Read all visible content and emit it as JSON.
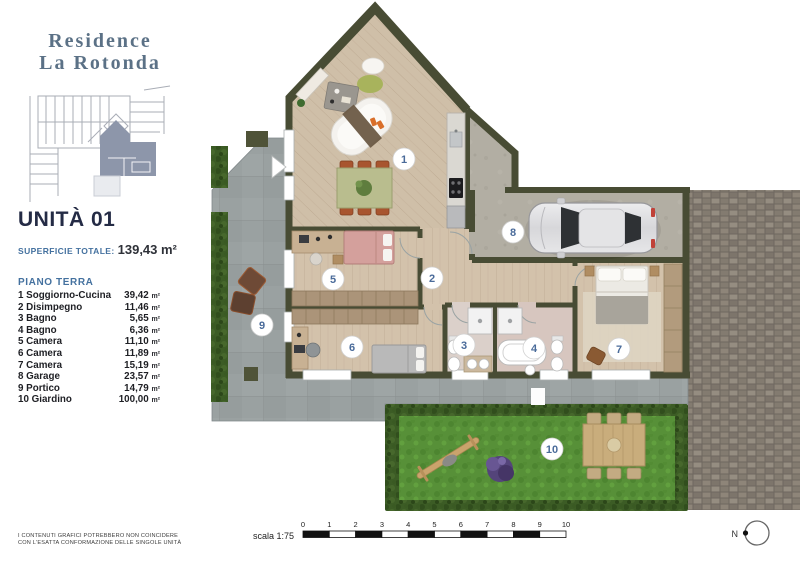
{
  "panel": {
    "brand_line1": "Residence",
    "brand_line2": "La Rotonda",
    "unit_title": "UNITÀ 01",
    "superficie_label": "SUPERFICIE TOTALE:",
    "superficie_value": "139,43 m²",
    "floor_label": "PIANO TERRA",
    "rooms": [
      {
        "name": "1 Soggiorno-Cucina",
        "value": "39,42",
        "unit": "m²"
      },
      {
        "name": "2 Disimpegno",
        "value": "11,46",
        "unit": "m²"
      },
      {
        "name": "3 Bagno",
        "value": "5,65",
        "unit": "m²"
      },
      {
        "name": "4 Bagno",
        "value": "6,36",
        "unit": "m²"
      },
      {
        "name": "5 Camera",
        "value": "11,10",
        "unit": "m²"
      },
      {
        "name": "6 Camera",
        "value": "11,89",
        "unit": "m²"
      },
      {
        "name": "7 Camera",
        "value": "15,19",
        "unit": "m²"
      },
      {
        "name": "8 Garage",
        "value": "23,57",
        "unit": "m²"
      },
      {
        "name": "9 Portico",
        "value": "14,79",
        "unit": "m²"
      },
      {
        "name": "10 Giardino",
        "value": "100,00",
        "unit": "m²"
      }
    ],
    "disclaimer_line1": "I CONTENUTI GRAFICI POTREBBERO NON COINCIDERE",
    "disclaimer_line2": "CON L'ESATTA CONFORMAZIONE DELLE SINGOLE UNITÀ"
  },
  "plan": {
    "markers": [
      {
        "label": "1"
      },
      {
        "label": "2"
      },
      {
        "label": "3"
      },
      {
        "label": "4"
      },
      {
        "label": "5"
      },
      {
        "label": "6"
      },
      {
        "label": "7"
      },
      {
        "label": "8"
      },
      {
        "label": "9"
      },
      {
        "label": "10"
      }
    ]
  },
  "scale": {
    "label": "scala 1:75",
    "ticks": [
      "0",
      "1",
      "2",
      "3",
      "4",
      "5",
      "6",
      "7",
      "8",
      "9",
      "10"
    ]
  },
  "compass": {
    "label": "N"
  },
  "colors": {
    "brand_blue": "#5b7186",
    "accent_blue": "#44719f",
    "dark_navy": "#242b45",
    "wall_olive": "#484c34",
    "marker_number_blue": "#4a6b9a",
    "grass_green": "#579038",
    "hedge_green": "#3c5c25",
    "wood_floor": "#d3c2ab",
    "patio_gray": "#9aa1a1",
    "paver_gray": "#867d72"
  }
}
